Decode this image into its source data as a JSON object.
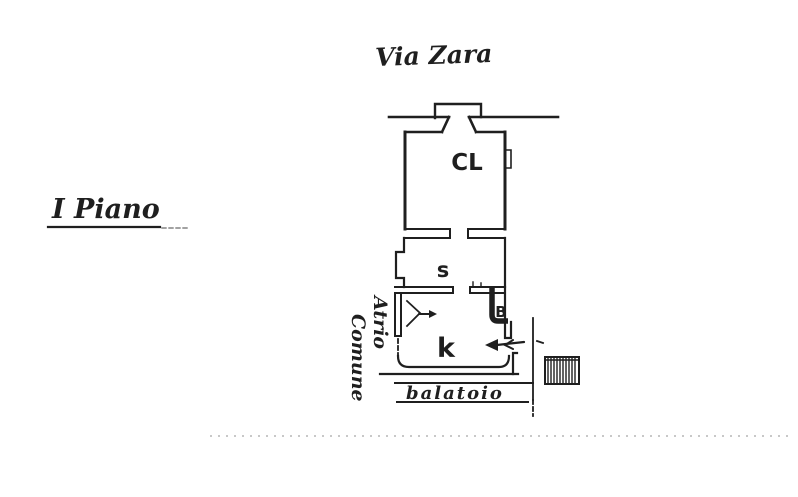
{
  "page": {
    "background": "#ffffff",
    "ink": "#1f1f1f",
    "faint": "#b5b5b5"
  },
  "labels": {
    "street": "Via Zara",
    "floor": "I Piano",
    "atrio_line1": "Atrio",
    "atrio_line2": "Comune",
    "balcony": "balatoio"
  },
  "rooms": {
    "cl": "CL",
    "s": "s",
    "k": "k",
    "b": "B"
  }
}
